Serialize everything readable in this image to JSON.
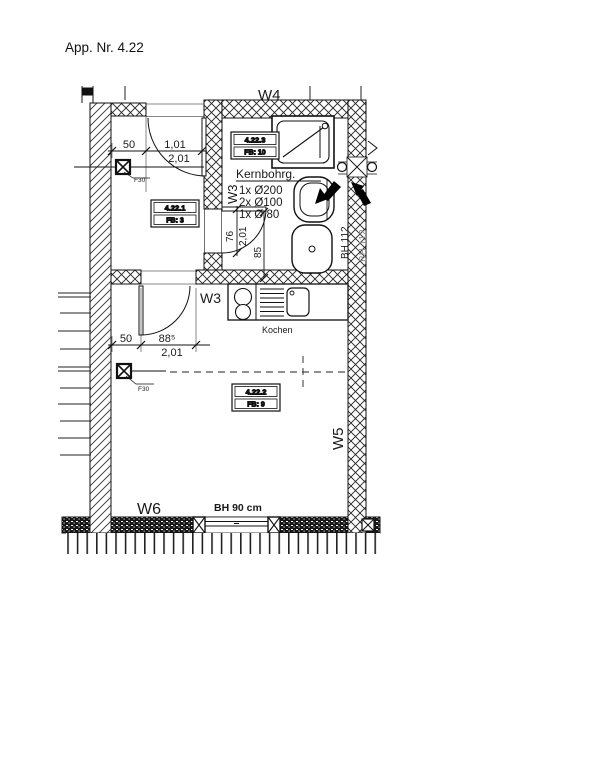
{
  "title": "App. Nr. 4.22",
  "colors": {
    "ink": "#1a1a1a",
    "muted": "#8a8a8a"
  },
  "walls": {
    "w4": "W4",
    "w3_bath": "W3",
    "w3_main": "W3",
    "w5": "W5",
    "w6": "W6"
  },
  "room_tags": [
    {
      "id": "4.22.1",
      "fb": "FB: 3"
    },
    {
      "id": "4.22.2",
      "fb": "FB: 9"
    },
    {
      "id": "4.22.3",
      "fb": "FB: 10"
    }
  ],
  "annotations": {
    "kernbohrung_title": "Kernbohrg.",
    "kernbohrung_lines": [
      "1x Ø200",
      "2x Ø100",
      "1x Ø 80"
    ],
    "kitchen_label": "Kochen",
    "bh_112_inner": "BH 112",
    "bh_112_outer": "BH 112",
    "window_sill": "BH 90 cm",
    "fire_rating_top": "F30",
    "fire_rating_bottom": "F30"
  },
  "dimensions": {
    "entry_offset": "50",
    "entry_door_width": "1,01",
    "entry_door_height": "2,01",
    "bath_door_width": "76",
    "bath_door_height": "2,01",
    "basin_distance": "85",
    "main_offset": "50",
    "main_door_width": "88⁵",
    "main_door_height": "2,01"
  }
}
